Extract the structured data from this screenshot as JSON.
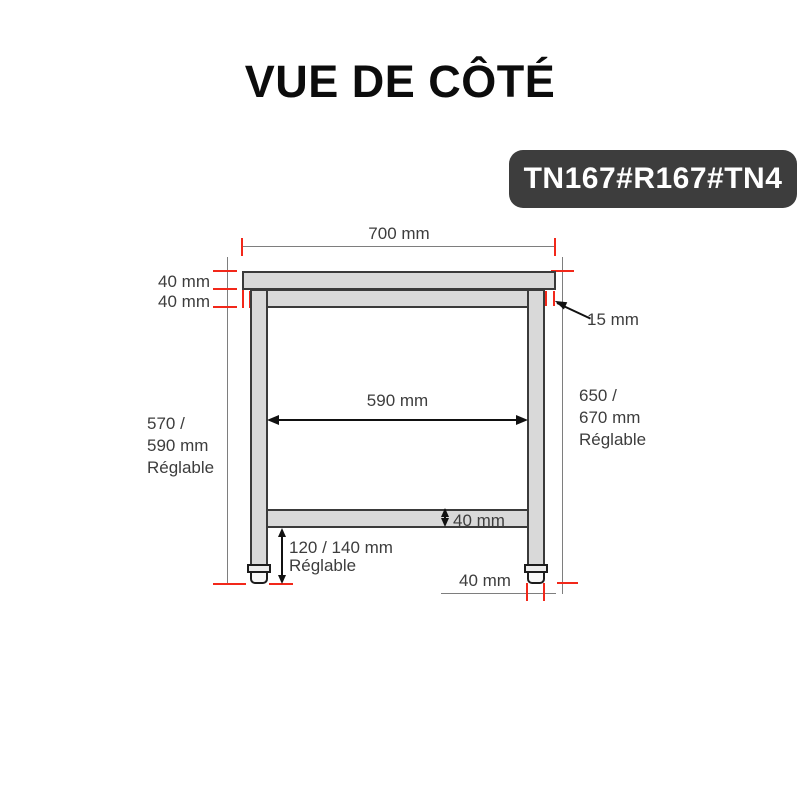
{
  "title": "VUE DE CÔTÉ",
  "badge": {
    "text": "TN167#R167#TN4",
    "background": "#3d3d3d",
    "text_color": "#ffffff"
  },
  "diagram": {
    "type": "technical-side-view-table-drawing",
    "colors": {
      "dimension_red": "#f2281a",
      "part_fill": "#d9d9d9",
      "part_border": "#3a3a3a",
      "thin_line_gray": "#7e7e7e",
      "label_text": "#3d3d3d",
      "arrow_black": "#111111"
    },
    "labels": {
      "top_width": "700 mm",
      "tabletop_thickness": "40 mm",
      "apron_thickness": "40 mm",
      "edge_overhang": "15 mm",
      "inner_width": "590 mm",
      "left_height_lines": [
        "570 /",
        "590 mm",
        "Réglable"
      ],
      "right_height_lines": [
        "650 /",
        "670 mm",
        "Réglable"
      ],
      "shelf_thickness": "40 mm",
      "foot_clearance_lines": [
        "120 / 140 mm",
        "Réglable"
      ],
      "leg_width": "40 mm"
    }
  }
}
